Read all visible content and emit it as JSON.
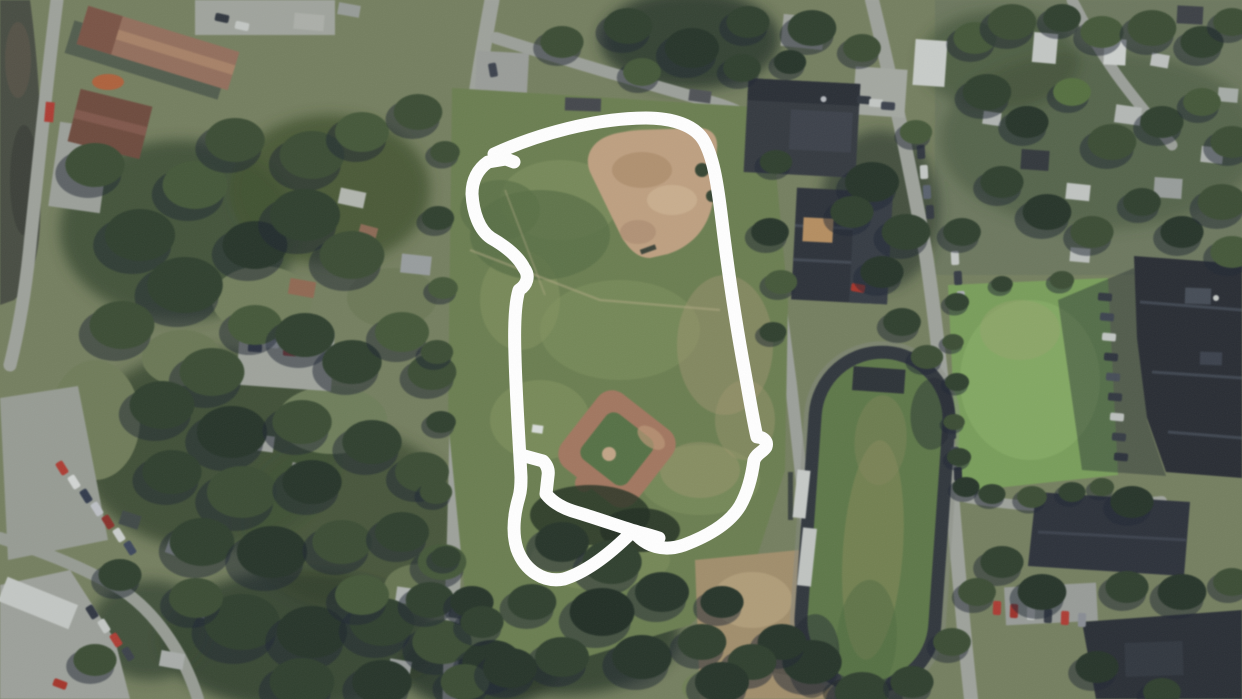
{
  "view": {
    "type": "aerial-satellite-imagery",
    "width_px": 1242,
    "height_px": 699,
    "description": "Aerial satellite view of a suburban neighborhood. A white hand-drawn freehand loop outlines a rectangular grass park containing a large baseball diamond (north) and a small baseball diamond (south). East of the park are school buildings, a running track with bleachers, a bright practice field, and a large dark-roofed school complex. West side shows forested residential blocks, parking lots with parked cars, a red-roofed commercial building and a river strip at the far left edge."
  },
  "annotation": {
    "tool": "freehand-pen",
    "color": "#ffffff",
    "stroke_width_px": 13,
    "shape": "irregular hand-drawn closed loop with small hooks and an inner doubled stroke at the bottom",
    "encloses": "park with two baseball diamonds"
  },
  "palette": {
    "ground_base": "#76815f",
    "residential_base": "#6e7a5e",
    "water": "#474c41",
    "road": "#a2a69e",
    "grass_park": "#6c8050",
    "grass_bright": "#7ba25a",
    "track_infield": "#5e7a47",
    "track_surface": "#2f353a",
    "dirt_infield": "#c3a482",
    "clay_diamond": "#a6795f",
    "dirt_field": "#a5916c",
    "roof_red": "#96705c",
    "building_dark": "#2b3037",
    "building_large": "#262b31",
    "trees_dark": "#2c3b2a",
    "shadow": "#1b2430",
    "bleachers": "#ccd0cc",
    "annotation_white": "#ffffff"
  }
}
